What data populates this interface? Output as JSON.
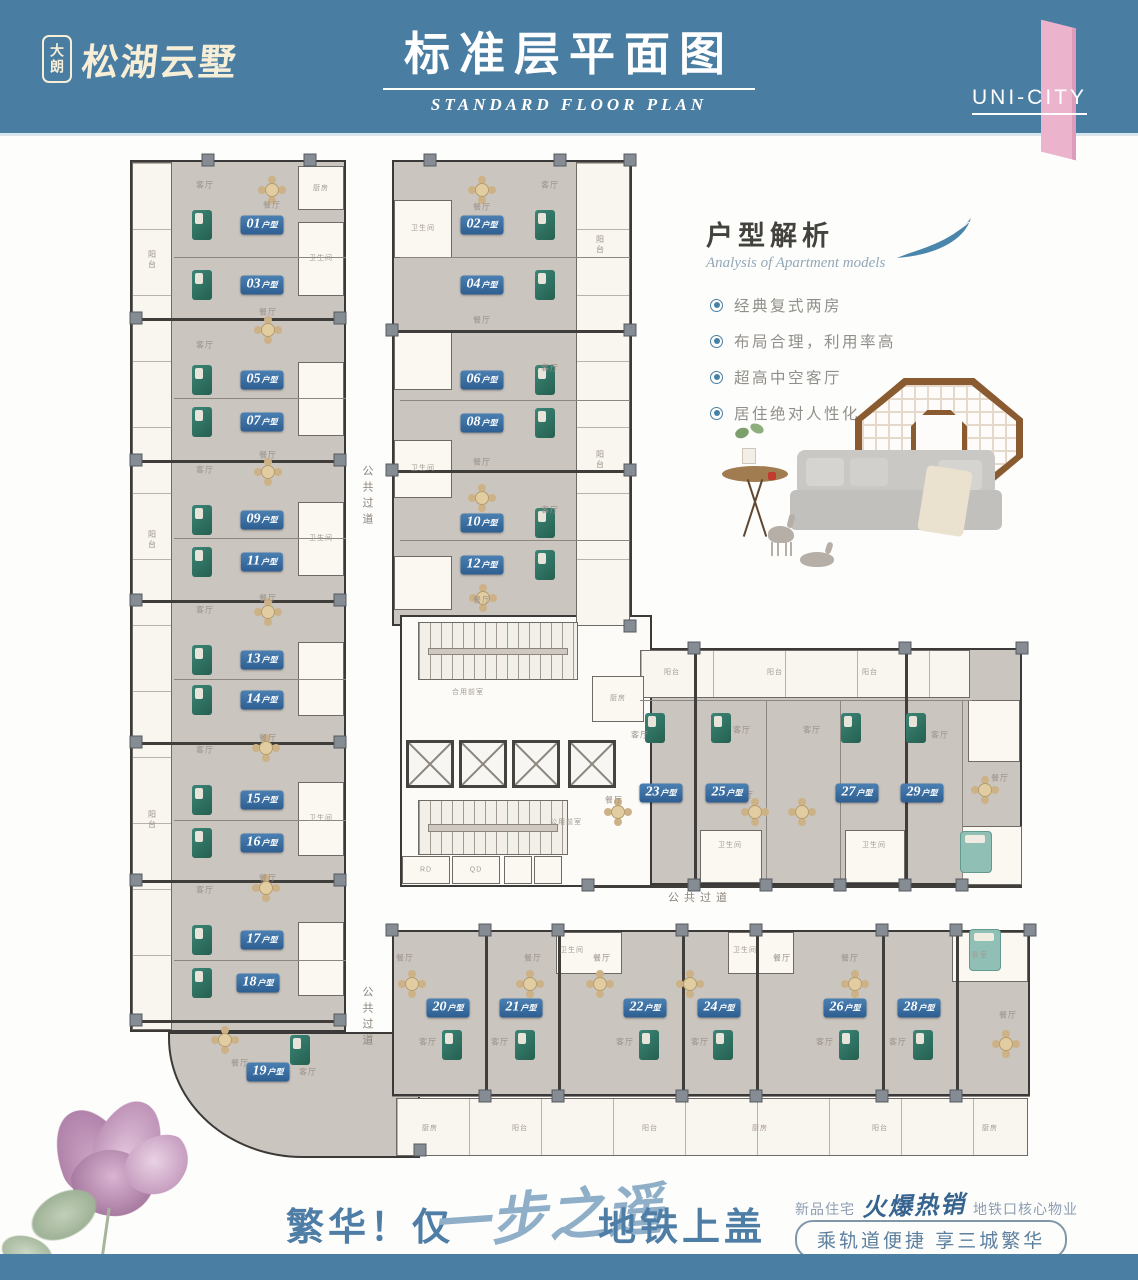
{
  "header": {
    "logo_badge": "大朗",
    "logo_name": "松湖云墅",
    "title": "标准层平面图",
    "subtitle": "STANDARD FLOOR PLAN",
    "corner": "UNI-CITY",
    "colors": {
      "band": "#4a7da2",
      "pink": "#ecb4cc",
      "cream": "#f6eed6"
    }
  },
  "analysis": {
    "title": "户型解析",
    "subtitle": "Analysis of Apartment models",
    "bullets": [
      "经典复式两房",
      "布局合理，利用率高",
      "超高中空客厅",
      "居住绝对人性化"
    ],
    "accent": "#4a80a6"
  },
  "footer": {
    "slogan_left": "繁华！仅",
    "slogan_script": "一步之遥",
    "slogan_right": "地铁上盖",
    "promo_prefix": "新品住宅",
    "promo_script": "火爆热销",
    "promo_suffix": "地铁口核心物业",
    "pill": "乘轨道便捷  享三城繁华"
  },
  "floorplan": {
    "unit_suffix": "户型",
    "colors": {
      "unit_fill": "#cbc5bf",
      "wall": "#403e3b",
      "chip": "#3a70a5",
      "pillar": "#868c94"
    },
    "blocks": [
      [
        130,
        160,
        216,
        872
      ],
      [
        168,
        1032,
        252,
        126,
        "arc"
      ],
      [
        392,
        160,
        240,
        466
      ],
      [
        588,
        648,
        434,
        237
      ],
      [
        392,
        930,
        638,
        166
      ],
      [
        400,
        615,
        252,
        272,
        "core"
      ]
    ],
    "whiteRooms": [
      [
        132,
        162,
        40,
        868,
        "",
        "sv"
      ],
      [
        298,
        166,
        46,
        44
      ],
      [
        298,
        222,
        46,
        74
      ],
      [
        298,
        362,
        46,
        74
      ],
      [
        298,
        502,
        46,
        74
      ],
      [
        298,
        642,
        46,
        74
      ],
      [
        298,
        782,
        46,
        74
      ],
      [
        298,
        922,
        46,
        74
      ],
      [
        394,
        200,
        58,
        58
      ],
      [
        394,
        332,
        58,
        58
      ],
      [
        394,
        440,
        58,
        58
      ],
      [
        394,
        556,
        58,
        54
      ],
      [
        576,
        162,
        54,
        464,
        "",
        "sv"
      ],
      [
        640,
        650,
        330,
        48,
        "",
        "sh"
      ],
      [
        592,
        676,
        52,
        46
      ],
      [
        700,
        830,
        62,
        53
      ],
      [
        845,
        830,
        60,
        53
      ],
      [
        968,
        700,
        52,
        62
      ],
      [
        962,
        826,
        60,
        59
      ],
      [
        556,
        932,
        66,
        42
      ],
      [
        728,
        932,
        66,
        42
      ],
      [
        952,
        932,
        76,
        50
      ],
      [
        396,
        1098,
        632,
        58,
        "",
        "sh"
      ],
      [
        402,
        856,
        48,
        28
      ],
      [
        452,
        856,
        48,
        28
      ],
      [
        504,
        856,
        28,
        28
      ],
      [
        534,
        856,
        28,
        28
      ]
    ],
    "hwalls": [
      [
        132,
        318,
        214
      ],
      [
        132,
        460,
        214
      ],
      [
        132,
        600,
        214
      ],
      [
        132,
        742,
        214
      ],
      [
        132,
        880,
        214
      ],
      [
        132,
        1020,
        214
      ],
      [
        174,
        257,
        172,
        "m"
      ],
      [
        174,
        398,
        172,
        "m"
      ],
      [
        174,
        538,
        172,
        "m"
      ],
      [
        174,
        679,
        172,
        "m"
      ],
      [
        174,
        820,
        172,
        "m"
      ],
      [
        174,
        960,
        172,
        "m"
      ],
      [
        392,
        330,
        240
      ],
      [
        392,
        470,
        240
      ],
      [
        400,
        257,
        230,
        "m"
      ],
      [
        400,
        400,
        230,
        "m"
      ],
      [
        400,
        540,
        230,
        "m"
      ],
      [
        640,
        700,
        332,
        "m"
      ],
      [
        588,
        885,
        434
      ],
      [
        392,
        1096,
        638,
        "m"
      ]
    ],
    "vwalls": [
      [
        694,
        648,
        237
      ],
      [
        905,
        648,
        237
      ],
      [
        766,
        700,
        185,
        "m"
      ],
      [
        840,
        700,
        185,
        "m"
      ],
      [
        962,
        700,
        185,
        "m"
      ],
      [
        485,
        930,
        166
      ],
      [
        558,
        930,
        166
      ],
      [
        682,
        930,
        166
      ],
      [
        756,
        930,
        166
      ],
      [
        882,
        930,
        166
      ],
      [
        956,
        930,
        166
      ]
    ],
    "pillars": [
      [
        136,
        318
      ],
      [
        136,
        460
      ],
      [
        136,
        600
      ],
      [
        136,
        742
      ],
      [
        136,
        880
      ],
      [
        136,
        1020
      ],
      [
        340,
        318
      ],
      [
        340,
        460
      ],
      [
        340,
        600
      ],
      [
        340,
        742
      ],
      [
        340,
        880
      ],
      [
        340,
        1020
      ],
      [
        208,
        160
      ],
      [
        310,
        160
      ],
      [
        430,
        160
      ],
      [
        560,
        160
      ],
      [
        630,
        160
      ],
      [
        392,
        330
      ],
      [
        392,
        470
      ],
      [
        630,
        330
      ],
      [
        630,
        470
      ],
      [
        630,
        626
      ],
      [
        694,
        648
      ],
      [
        905,
        648
      ],
      [
        1022,
        648
      ],
      [
        588,
        885
      ],
      [
        694,
        885
      ],
      [
        766,
        885
      ],
      [
        840,
        885
      ],
      [
        905,
        885
      ],
      [
        962,
        885
      ],
      [
        392,
        930
      ],
      [
        485,
        930
      ],
      [
        558,
        930
      ],
      [
        682,
        930
      ],
      [
        756,
        930
      ],
      [
        882,
        930
      ],
      [
        956,
        930
      ],
      [
        1030,
        930
      ],
      [
        485,
        1096
      ],
      [
        558,
        1096
      ],
      [
        682,
        1096
      ],
      [
        756,
        1096
      ],
      [
        882,
        1096
      ],
      [
        956,
        1096
      ],
      [
        420,
        1150
      ]
    ],
    "stairs": [
      [
        418,
        622,
        160,
        58
      ],
      [
        418,
        800,
        150,
        55
      ]
    ],
    "elevators": [
      [
        406,
        740
      ],
      [
        459,
        740
      ],
      [
        512,
        740
      ],
      [
        568,
        740
      ]
    ],
    "units": [
      [
        "01",
        262,
        225
      ],
      [
        "03",
        262,
        285
      ],
      [
        "05",
        262,
        380
      ],
      [
        "07",
        262,
        422
      ],
      [
        "09",
        262,
        520
      ],
      [
        "11",
        262,
        562
      ],
      [
        "13",
        262,
        660
      ],
      [
        "14",
        262,
        700
      ],
      [
        "15",
        262,
        800
      ],
      [
        "16",
        262,
        843
      ],
      [
        "17",
        262,
        940
      ],
      [
        "18",
        258,
        983
      ],
      [
        "19",
        268,
        1072
      ],
      [
        "02",
        482,
        225
      ],
      [
        "04",
        482,
        285
      ],
      [
        "06",
        482,
        380
      ],
      [
        "08",
        482,
        423
      ],
      [
        "10",
        482,
        523
      ],
      [
        "12",
        482,
        565
      ],
      [
        "23",
        661,
        793
      ],
      [
        "25",
        727,
        793
      ],
      [
        "27",
        857,
        793
      ],
      [
        "29",
        922,
        793
      ],
      [
        "20",
        448,
        1008
      ],
      [
        "21",
        521,
        1008
      ],
      [
        "22",
        645,
        1008
      ],
      [
        "24",
        719,
        1008
      ],
      [
        "26",
        845,
        1008
      ],
      [
        "28",
        919,
        1008
      ]
    ],
    "texts": [
      [
        "公共过道",
        367,
        497,
        "cv"
      ],
      [
        "公共过道",
        367,
        1018,
        "cv"
      ],
      [
        "公共过道",
        700,
        897,
        "c"
      ],
      [
        "合用前室",
        468,
        692,
        "t"
      ],
      [
        "公用前室",
        566,
        822,
        "t"
      ],
      [
        "RD",
        426,
        870,
        "t"
      ],
      [
        "QD",
        476,
        870,
        "t"
      ],
      [
        "客厅",
        205,
        185,
        ""
      ],
      [
        "餐厅",
        272,
        205,
        ""
      ],
      [
        "餐厅",
        268,
        312,
        ""
      ],
      [
        "客厅",
        205,
        345,
        ""
      ],
      [
        "客厅",
        205,
        470,
        ""
      ],
      [
        "餐厅",
        268,
        455,
        ""
      ],
      [
        "客厅",
        205,
        610,
        ""
      ],
      [
        "餐厅",
        268,
        598,
        ""
      ],
      [
        "客厅",
        205,
        750,
        ""
      ],
      [
        "餐厅",
        268,
        738,
        ""
      ],
      [
        "客厅",
        205,
        890,
        ""
      ],
      [
        "餐厅",
        268,
        878,
        ""
      ],
      [
        "餐厅",
        240,
        1063,
        ""
      ],
      [
        "客厅",
        308,
        1072,
        ""
      ],
      [
        "厨房",
        321,
        188,
        "t"
      ],
      [
        "卫生间",
        321,
        258,
        "t"
      ],
      [
        "卫生间",
        321,
        538,
        "t"
      ],
      [
        "卫生间",
        321,
        818,
        "t"
      ],
      [
        "阳台",
        152,
        260,
        "rv"
      ],
      [
        "阳台",
        152,
        540,
        "rv"
      ],
      [
        "阳台",
        152,
        820,
        "rv"
      ],
      [
        "餐厅",
        482,
        207,
        ""
      ],
      [
        "客厅",
        550,
        185,
        ""
      ],
      [
        "餐厅",
        482,
        320,
        ""
      ],
      [
        "客厅",
        550,
        368,
        ""
      ],
      [
        "餐厅",
        482,
        462,
        ""
      ],
      [
        "客厅",
        550,
        510,
        ""
      ],
      [
        "餐厅",
        482,
        600,
        ""
      ],
      [
        "卫生间",
        423,
        228,
        "t"
      ],
      [
        "卫生间",
        423,
        468,
        "t"
      ],
      [
        "阳台",
        600,
        245,
        "rv"
      ],
      [
        "阳台",
        600,
        460,
        "rv"
      ],
      [
        "厨房",
        618,
        698,
        "t"
      ],
      [
        "阳台",
        672,
        672,
        "t"
      ],
      [
        "阳台",
        775,
        672,
        "t"
      ],
      [
        "阳台",
        870,
        672,
        "t"
      ],
      [
        "客厅",
        640,
        735,
        ""
      ],
      [
        "客厅",
        742,
        730,
        ""
      ],
      [
        "客厅",
        812,
        730,
        ""
      ],
      [
        "客厅",
        940,
        735,
        ""
      ],
      [
        "餐厅",
        614,
        800,
        ""
      ],
      [
        "餐厅",
        745,
        795,
        ""
      ],
      [
        "餐厅",
        1000,
        778,
        ""
      ],
      [
        "卫生间",
        730,
        845,
        "t"
      ],
      [
        "卫生间",
        874,
        845,
        "t"
      ],
      [
        "餐厅",
        405,
        958,
        ""
      ],
      [
        "餐厅",
        533,
        958,
        ""
      ],
      [
        "餐厅",
        602,
        958,
        ""
      ],
      [
        "餐厅",
        782,
        958,
        ""
      ],
      [
        "餐厅",
        850,
        958,
        ""
      ],
      [
        "餐厅",
        1008,
        1015,
        ""
      ],
      [
        "客厅",
        428,
        1042,
        ""
      ],
      [
        "客厅",
        500,
        1042,
        ""
      ],
      [
        "客厅",
        625,
        1042,
        ""
      ],
      [
        "客厅",
        700,
        1042,
        ""
      ],
      [
        "客厅",
        825,
        1042,
        ""
      ],
      [
        "客厅",
        898,
        1042,
        ""
      ],
      [
        "卫生间",
        572,
        950,
        "t"
      ],
      [
        "卫生间",
        745,
        950,
        "t"
      ],
      [
        "卧室",
        980,
        955,
        "t"
      ],
      [
        "厨房",
        430,
        1128,
        "t"
      ],
      [
        "阳台",
        520,
        1128,
        "t"
      ],
      [
        "阳台",
        650,
        1128,
        "t"
      ],
      [
        "厨房",
        760,
        1128,
        "t"
      ],
      [
        "阳台",
        880,
        1128,
        "t"
      ],
      [
        "厨房",
        990,
        1128,
        "t"
      ]
    ],
    "sofas": [
      [
        202,
        225
      ],
      [
        202,
        285
      ],
      [
        202,
        380
      ],
      [
        202,
        422
      ],
      [
        202,
        520
      ],
      [
        202,
        562
      ],
      [
        202,
        660
      ],
      [
        202,
        700
      ],
      [
        202,
        800
      ],
      [
        202,
        843
      ],
      [
        202,
        940
      ],
      [
        202,
        983
      ],
      [
        300,
        1050
      ],
      [
        545,
        225
      ],
      [
        545,
        285
      ],
      [
        545,
        380
      ],
      [
        545,
        423
      ],
      [
        545,
        523
      ],
      [
        545,
        565
      ],
      [
        655,
        728
      ],
      [
        721,
        728
      ],
      [
        851,
        728
      ],
      [
        916,
        728
      ],
      [
        452,
        1045
      ],
      [
        525,
        1045
      ],
      [
        649,
        1045
      ],
      [
        723,
        1045
      ],
      [
        849,
        1045
      ],
      [
        923,
        1045
      ]
    ],
    "tables": [
      [
        272,
        190
      ],
      [
        268,
        330
      ],
      [
        268,
        472
      ],
      [
        268,
        612
      ],
      [
        266,
        748
      ],
      [
        266,
        888
      ],
      [
        225,
        1040
      ],
      [
        482,
        190
      ],
      [
        482,
        498
      ],
      [
        483,
        598
      ],
      [
        618,
        812
      ],
      [
        755,
        812
      ],
      [
        802,
        812
      ],
      [
        985,
        790
      ],
      [
        412,
        984
      ],
      [
        530,
        984
      ],
      [
        600,
        984
      ],
      [
        690,
        984
      ],
      [
        855,
        984
      ],
      [
        1006,
        1044
      ]
    ],
    "beds": [
      [
        976,
        852
      ],
      [
        985,
        950
      ]
    ]
  }
}
